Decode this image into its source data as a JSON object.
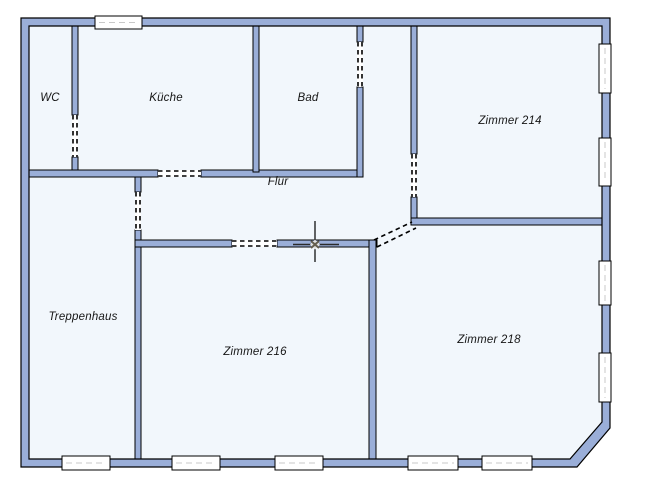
{
  "colors": {
    "background": "#ffffff",
    "wall_fill": "#9aaed8",
    "wall_stroke": "#000000",
    "room_fill": "#f2f7fc",
    "window_fill": "#ffffff",
    "window_dash": "#c9c9c9",
    "label_color": "#161616",
    "cursor_color": "#000000"
  },
  "rooms": [
    {
      "id": "wc",
      "label": "WC"
    },
    {
      "id": "kueche",
      "label": "Küche"
    },
    {
      "id": "bad",
      "label": "Bad"
    },
    {
      "id": "flur",
      "label": "Flur"
    },
    {
      "id": "zimmer-214",
      "label": "Zimmer 214"
    },
    {
      "id": "treppenhaus",
      "label": "Treppenhaus"
    },
    {
      "id": "zimmer-216",
      "label": "Zimmer 216"
    },
    {
      "id": "zimmer-218",
      "label": "Zimmer 218"
    }
  ],
  "cursor": {
    "kind": "cad-crosshair-with-snap-marker",
    "x": 315,
    "y": 244
  }
}
